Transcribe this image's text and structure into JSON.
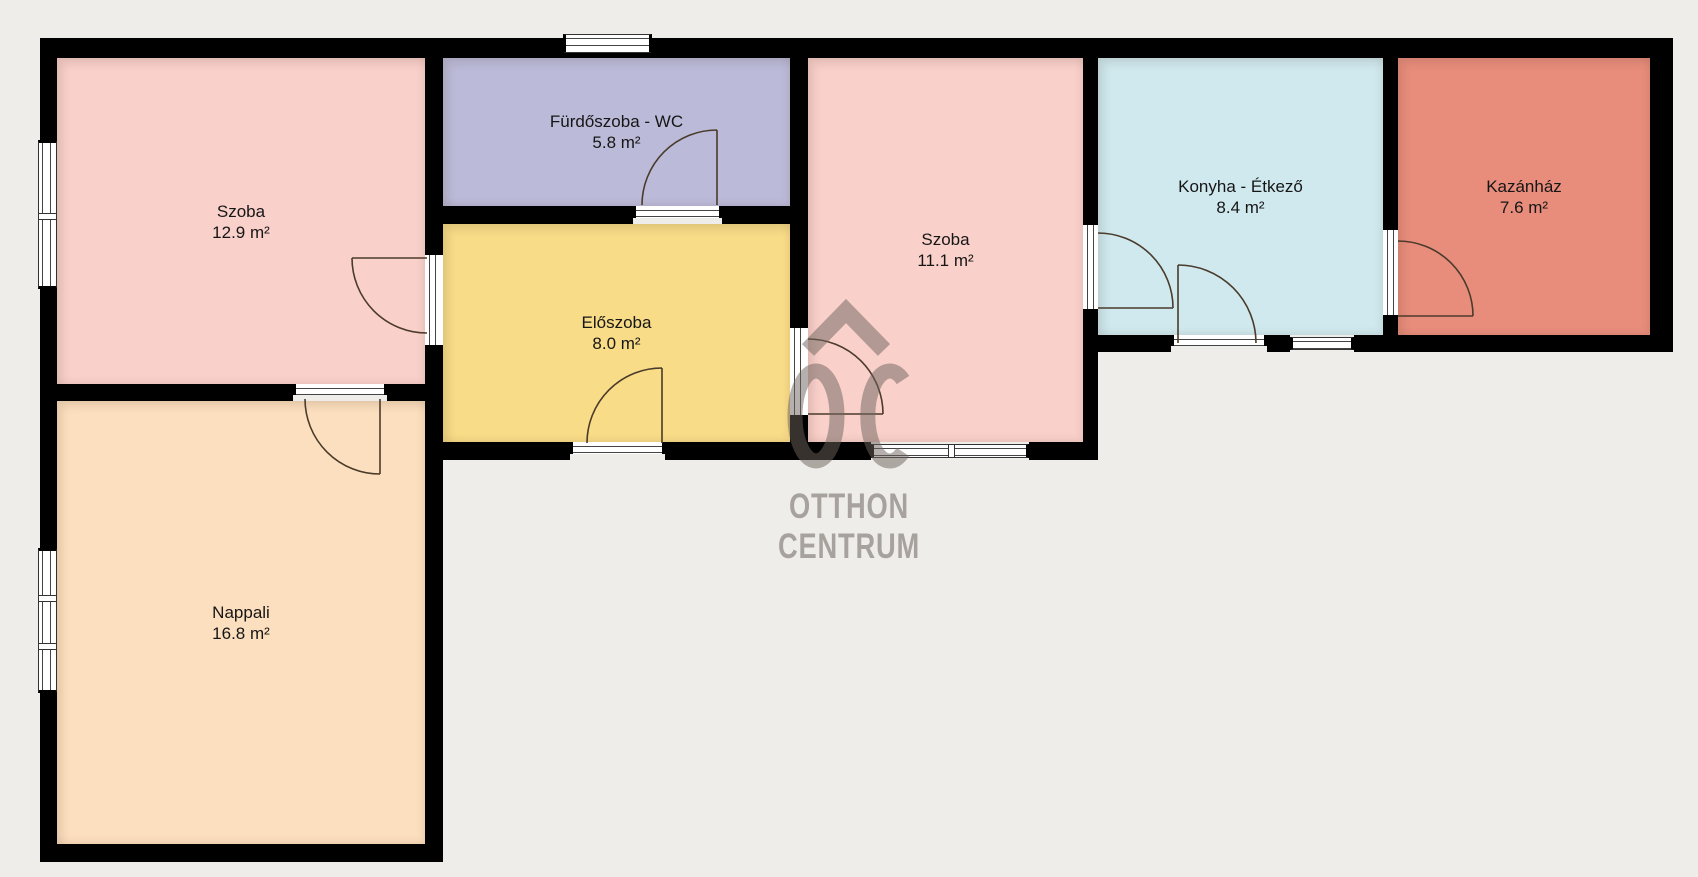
{
  "floorplan": {
    "background_color": "#eeedea",
    "wall_color": "#000000",
    "door_arc_color": "#4a3b2a",
    "rooms": [
      {
        "id": "szoba-1",
        "name": "Szoba",
        "area": "12.9 m²",
        "color": "#f9d0ca"
      },
      {
        "id": "furdoszoba",
        "name": "Fürdőszoba - WC",
        "area": "5.8 m²",
        "color": "#bbbad8"
      },
      {
        "id": "eloszoba",
        "name": "Előszoba",
        "area": "8.0 m²",
        "color": "#f8dc88"
      },
      {
        "id": "szoba-2",
        "name": "Szoba",
        "area": "11.1 m²",
        "color": "#f9d0ca"
      },
      {
        "id": "konyha",
        "name": "Konyha - Étkező",
        "area": "8.4 m²",
        "color": "#cfe9ee"
      },
      {
        "id": "kazanhaz",
        "name": "Kazánház",
        "area": "7.6 m²",
        "color": "#e88d7c"
      },
      {
        "id": "nappali",
        "name": "Nappali",
        "area": "16.8 m²",
        "color": "#fcdfbe"
      }
    ],
    "watermark": {
      "logo": "oc-house-monogram",
      "line1": "OTTHON",
      "line2": "CENTRUM",
      "color": "#6e645d"
    }
  }
}
